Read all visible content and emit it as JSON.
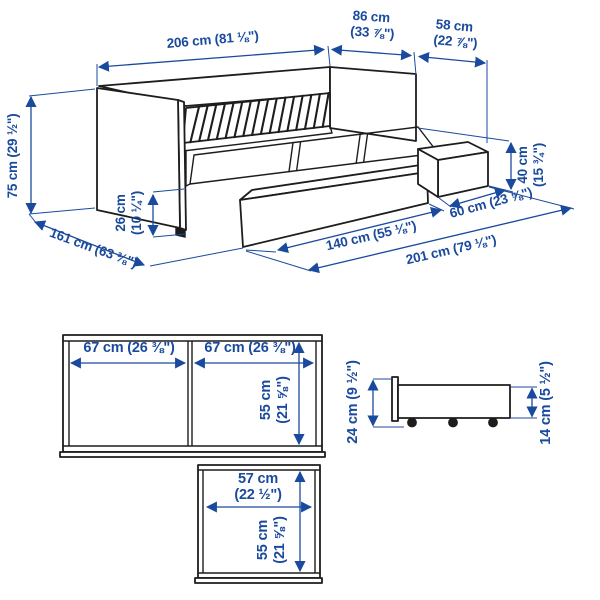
{
  "colors": {
    "dimension_blue": "#1a4a9e",
    "line_black": "#1d1d1d",
    "background": "#ffffff"
  },
  "perspective_view": {
    "length": "206 cm (81 ⅛\")",
    "depth_line1": "86 cm",
    "depth_line2": "(33 ⅞\")",
    "pullout_line1": "58 cm",
    "pullout_line2": "(22 ⅞\")",
    "height": "75 cm (29 ½\")",
    "total_depth": "161 cm (63 ⅜\")",
    "clearance_line1": "26 cm",
    "clearance_line2": "(10 ¼\")",
    "drawer_height_line1": "40 cm",
    "drawer_height_line2": "(15 ¾\")",
    "drawer_depth": "60 cm (23 ⅝\")",
    "drawer_width": "140 cm (55 ⅛\")",
    "base_length": "201 cm (79 ⅛\")"
  },
  "front_view": {
    "left_panel_width": "67 cm (26 ⅜\")",
    "right_panel_width": "67 cm (26 ⅜\")",
    "height_line1": "55 cm",
    "height_line2": "(21 ⅝\")"
  },
  "side_view": {
    "total_height": "24 cm (9 ½\")",
    "box_height": "14 cm (5 ½\")"
  },
  "top_view": {
    "width_line1": "57 cm",
    "width_line2": "(22 ½\")",
    "height_line1": "55 cm",
    "height_line2": "(21 ⅝\")"
  }
}
